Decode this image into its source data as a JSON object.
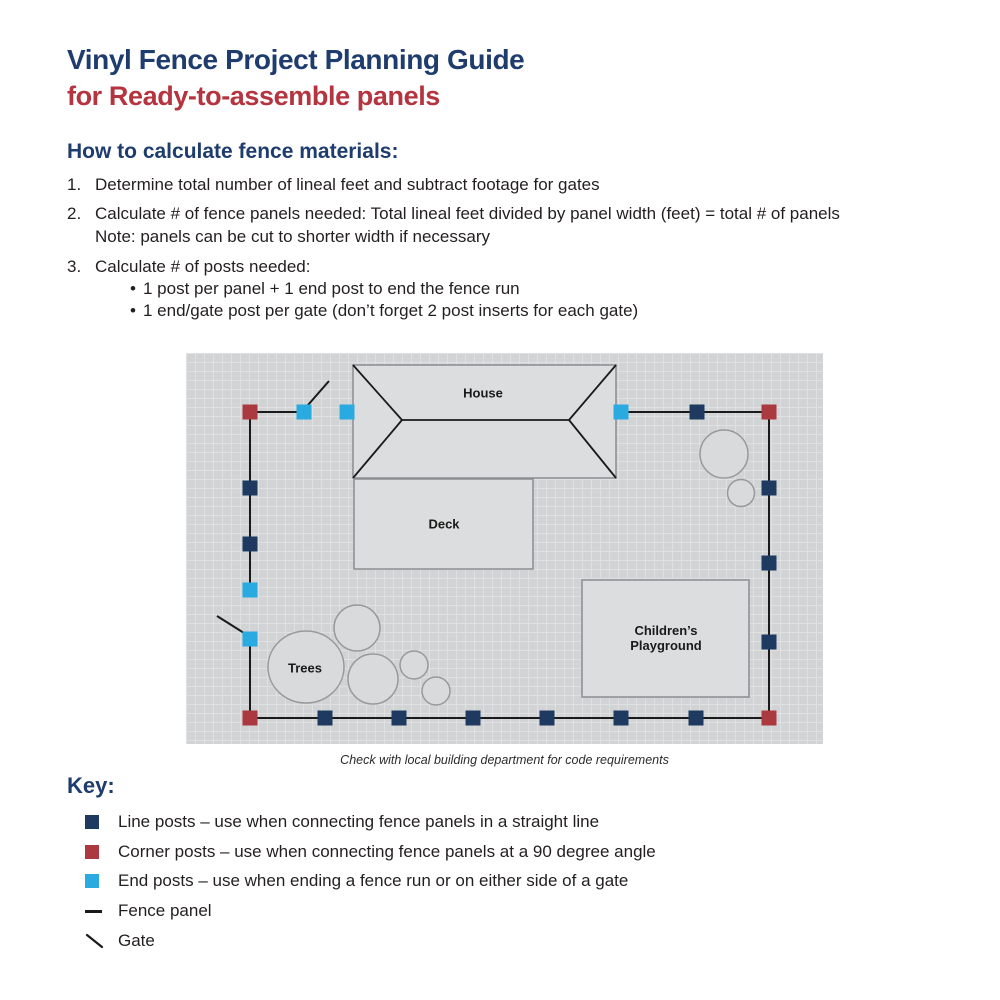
{
  "header": {
    "title": "Vinyl Fence Project Planning Guide",
    "subtitle": "for Ready-to-assemble panels"
  },
  "instructions": {
    "heading": "How to calculate fence materials:",
    "bullet_glyph": "•",
    "steps": [
      {
        "num": "1.",
        "text": "Determine total number of lineal feet and subtract footage for gates"
      },
      {
        "num": "2.",
        "text": "Calculate # of fence panels needed: Total lineal feet divided by panel width (feet) = total # of panels",
        "note": "Note: panels can be cut to shorter width if necessary"
      },
      {
        "num": "3.",
        "text": "Calculate # of posts needed:",
        "bullets": [
          "1 post per panel + 1 end post to end the fence run",
          "1 end/gate post per gate (don’t forget 2 post inserts for each gate)"
        ]
      }
    ]
  },
  "diagram": {
    "labels": {
      "house": "House",
      "deck": "Deck",
      "trees": "Trees",
      "playground_line1": "Children’s",
      "playground_line2": "Playground"
    },
    "caption": "Check with local building department for code requirements"
  },
  "key": {
    "heading": "Key:",
    "items": [
      {
        "marker": "line-post",
        "text": "Line posts – use when connecting fence panels in a straight line"
      },
      {
        "marker": "corner-post",
        "text": "Corner posts – use when connecting fence panels at a 90 degree angle"
      },
      {
        "marker": "end-post",
        "text": "End posts – use when ending a fence run or on either side of a gate"
      },
      {
        "marker": "fence-panel",
        "text": "Fence panel"
      },
      {
        "marker": "gate",
        "text": "Gate"
      }
    ]
  },
  "colors": {
    "navy": "#1e3c6d",
    "red": "#b43440",
    "line_post": "#1e3a60",
    "corner_post": "#ab3a40",
    "end_post": "#29aae1",
    "text": "#231f20",
    "grid_bg": "#d2d3d4",
    "grid_line": "#dee0e1",
    "building_fill": "#dcddde",
    "building_stroke": "#8b8d90",
    "tree_fill": "#d9dadb",
    "tree_stroke": "#97999b",
    "fence": "#1a1a1a"
  }
}
